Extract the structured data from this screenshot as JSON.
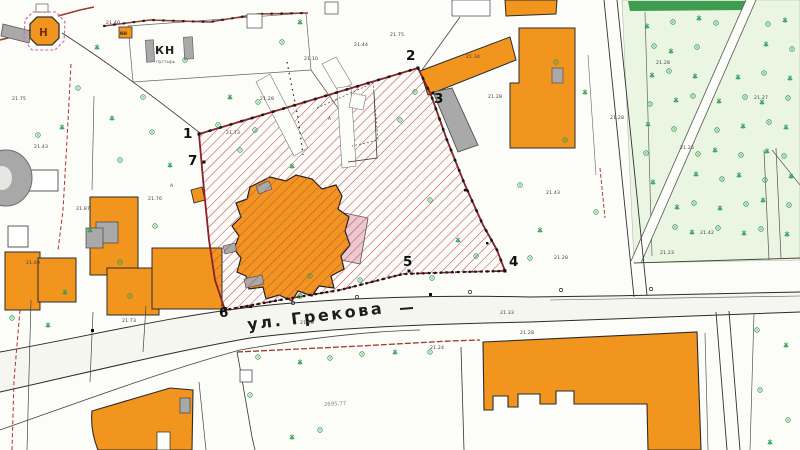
{
  "map": {
    "street": {
      "name": "ул. Грекова"
    },
    "landmark": {
      "letter": "Н"
    },
    "cadastral": {
      "label": "КН",
      "sublabel": "пустырь",
      "small_label": "КН"
    },
    "boundary_points": [
      {
        "n": "1"
      },
      {
        "n": "2"
      },
      {
        "n": "3"
      },
      {
        "n": "4"
      },
      {
        "n": "5"
      },
      {
        "n": "6"
      },
      {
        "n": "7"
      }
    ],
    "annotations": [
      "21.75",
      "21.43",
      "21.87",
      "21.69",
      "21.73",
      "21.73",
      "21.28",
      "21.10",
      "21.44",
      "21.75",
      "21.34",
      "21.28",
      "21.43",
      "21.28",
      "21.28",
      "21.28",
      "21.25",
      "21.42",
      "21.27",
      "21.23",
      "2695,77",
      "21.24",
      "21.28",
      "21.33",
      "21.28",
      "А",
      "А",
      "21.76",
      "21.40"
    ],
    "colors": {
      "building_orange": "#F2951F",
      "hatch_red": "#BF4A52",
      "boundary_red": "#8B2025",
      "gray_building": "#A9A9A9",
      "tree_green": "#2E9E4E",
      "park_green": "#EAF5E2",
      "park_strip_green": "#3F9D52",
      "annex_pink": "#EBC8CE",
      "road_brown": "#9C3B2E"
    }
  }
}
